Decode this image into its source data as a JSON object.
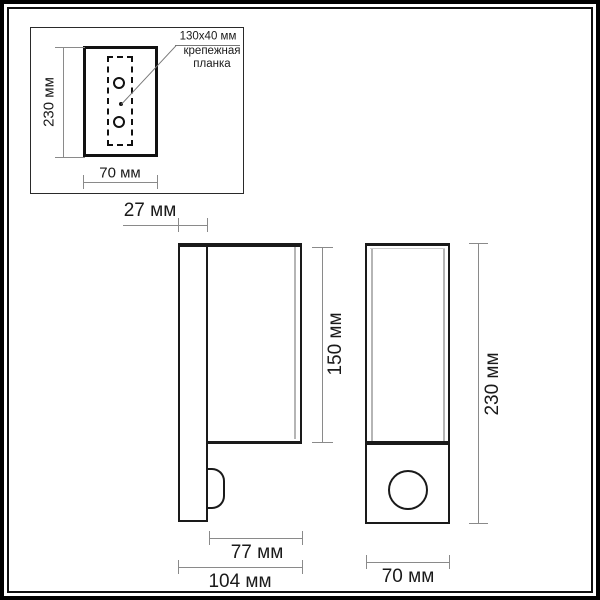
{
  "inset": {
    "height_label": "230 мм",
    "width_label": "70 мм",
    "annotation": {
      "size": "130x40 мм",
      "name_line1": "крепежная",
      "name_line2": "планка"
    }
  },
  "side_view": {
    "bracket_depth_label": "27 мм",
    "body_height_label": "150 мм",
    "body_depth_label": "77 мм",
    "total_depth_label": "104 мм"
  },
  "front_view": {
    "height_label": "230 мм",
    "width_label": "70 мм"
  },
  "colors": {
    "line_dark": "#1a1a1a",
    "dimension_line": "#8a8a8a",
    "inner_edge_gray": "#b5b5b5",
    "background": "#ffffff"
  }
}
